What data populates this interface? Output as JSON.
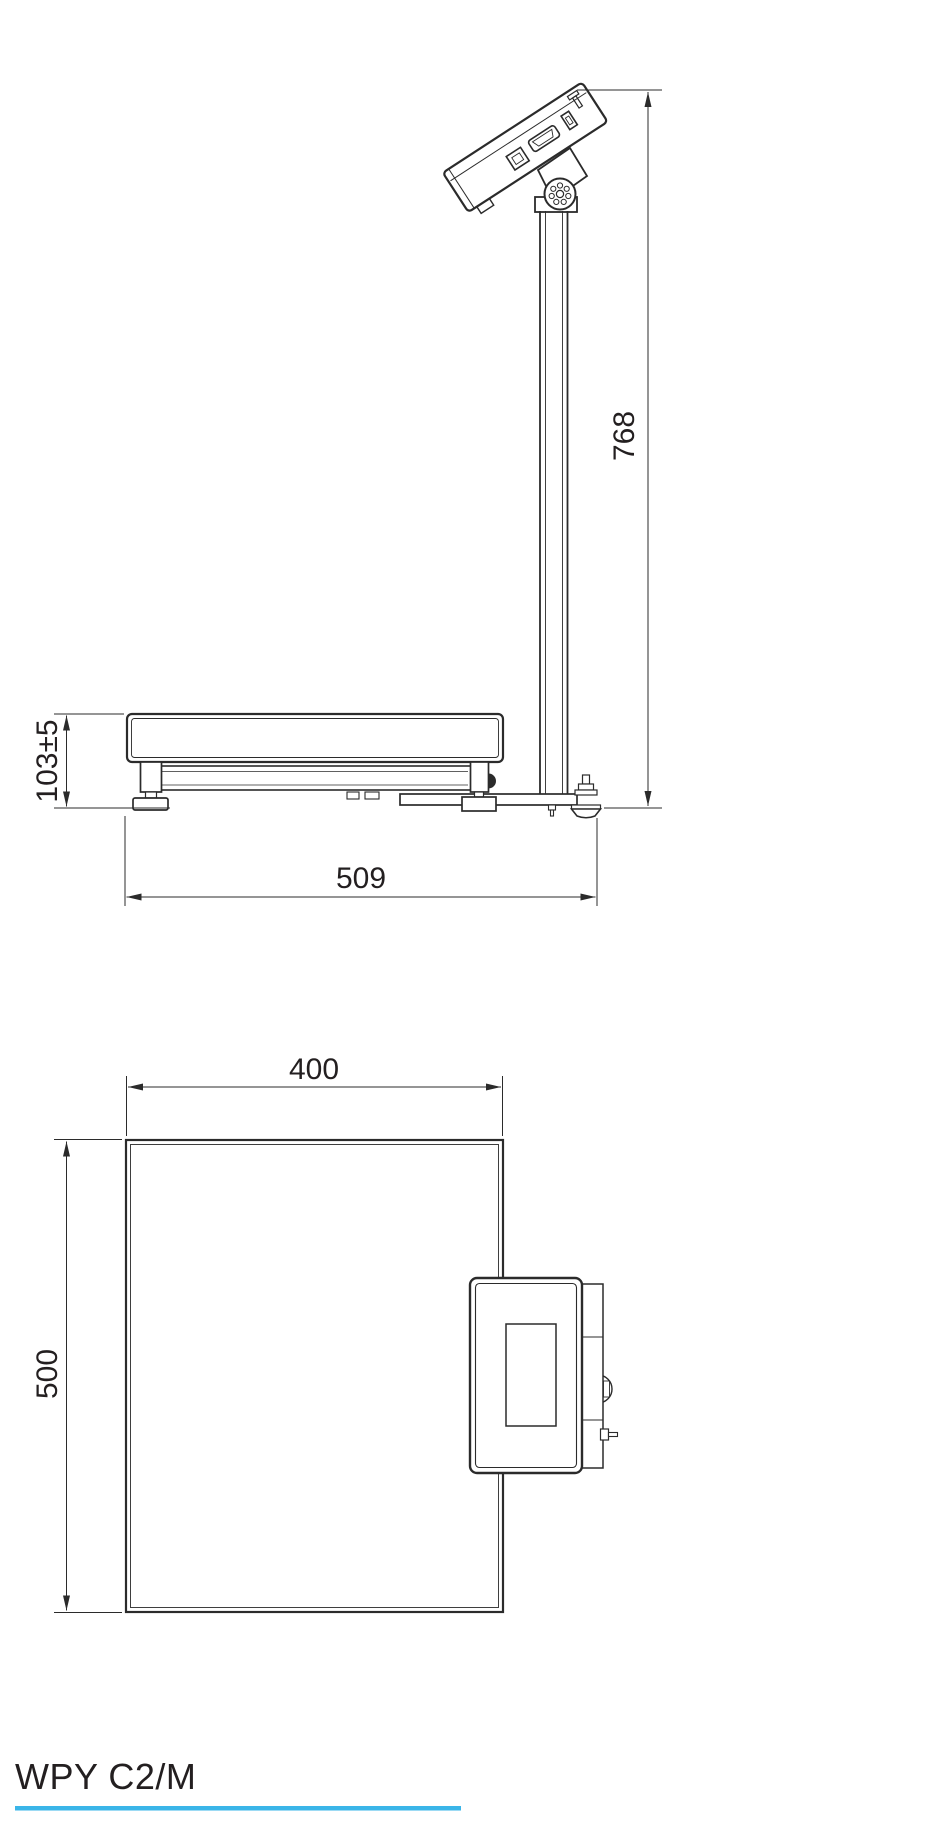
{
  "drawing": {
    "side_view": {
      "dim_height": "768",
      "dim_platform_height": "103±5",
      "dim_depth": "509"
    },
    "top_view": {
      "dim_width": "400",
      "dim_depth": "500"
    }
  },
  "footer": {
    "model": "WPY C2/M"
  },
  "colors": {
    "line": "#2b2b2b",
    "label": "#231f20",
    "accent": "#3ab5e8",
    "background": "#ffffff"
  }
}
